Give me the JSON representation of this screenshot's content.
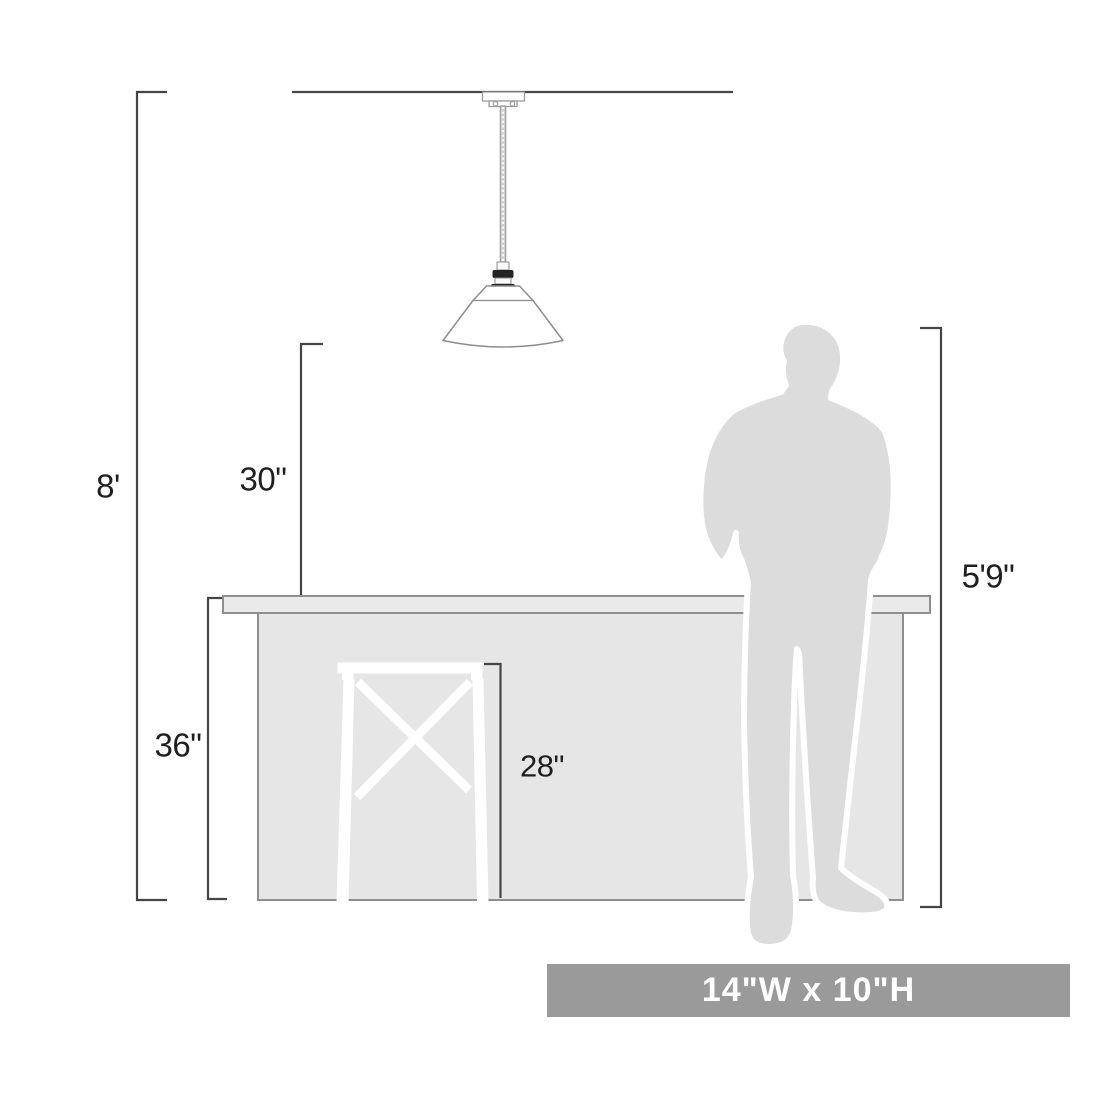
{
  "diagram": {
    "title": "Pendant light mounting-height scale diagram",
    "objects": {
      "ceiling": "ceiling-line",
      "fixture": "cone-shade-pendant-light",
      "counter": "kitchen-island-counter",
      "stool": "x-frame-bar-stool",
      "person": "standing-man-silhouette"
    },
    "dimensions": {
      "ceiling_height": {
        "label": "8'"
      },
      "fixture_clearance": {
        "label": "30\""
      },
      "counter_height": {
        "label": "36\""
      },
      "stool_height": {
        "label": "28\""
      },
      "person_height": {
        "label": "5'9\""
      }
    },
    "banner": {
      "label": "14\"W x 10\"H"
    },
    "colors": {
      "banner_bg": "#9a9a9a",
      "banner_text": "#ffffff",
      "dimension_line": "#454545",
      "label_text": "#1f1f1f",
      "counter_fill": "#e6e6e6",
      "counter_top_fill": "#eaeaea",
      "counter_stroke": "#8f8f8f",
      "silhouette_fill": "#dcdcdc",
      "silhouette_outline": "#ffffff",
      "fixture_stroke": "#8d8d8d",
      "socket_dark": "#242424",
      "stool_fill": "#ffffff"
    }
  }
}
